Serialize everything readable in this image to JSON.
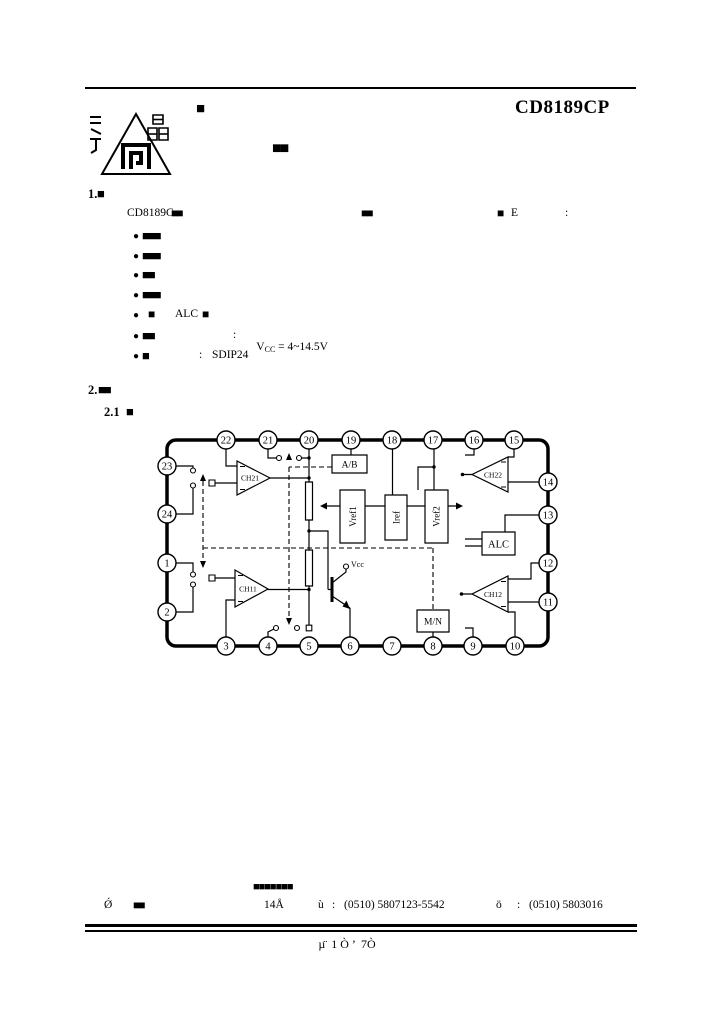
{
  "page": {
    "title": "CD8189CP",
    "top_blob": "■",
    "subtitle_blob": "■■",
    "page_number": "µ̈  1 Ò ’  7Ò"
  },
  "section1": {
    "num": "1.",
    "num_blob": "■",
    "intro": {
      "lead": "CD8189C",
      "blob1": "■■",
      "blob2": "■■",
      "blob3": "■",
      "suffix": "E",
      "colon": ":"
    },
    "bullets": {
      "b1": {
        "dot": "●",
        "blob": "■■■"
      },
      "b2": {
        "dot": "●",
        "blob": "■■■"
      },
      "b3": {
        "dot": "●",
        "blob": "■■"
      },
      "b4": {
        "dot": "●",
        "blob": "■■■"
      },
      "b5": {
        "dot": "●",
        "blob1": "■",
        "text": "ALC",
        "blob2": "■"
      },
      "b6": {
        "dot": "●",
        "blob": "■■",
        "colon": ":",
        "v": "V",
        "vsub": "CC",
        "rest": " = 4~14.5V"
      },
      "b7": {
        "dot": "●",
        "blob": "■",
        "colon": ":",
        "text": "SDIP24"
      }
    }
  },
  "section2": {
    "num": "2.",
    "blob": "■■",
    "subnum": "2.1",
    "subblob": "■"
  },
  "diagram": {
    "pins": {
      "p1": "1",
      "p2": "2",
      "p3": "3",
      "p4": "4",
      "p5": "5",
      "p6": "6",
      "p7": "7",
      "p8": "8",
      "p9": "9",
      "p10": "10",
      "p11": "11",
      "p12": "12",
      "p13": "13",
      "p14": "14",
      "p15": "15",
      "p16": "16",
      "p17": "17",
      "p18": "18",
      "p19": "19",
      "p20": "20",
      "p21": "21",
      "p22": "22",
      "p23": "23",
      "p24": "24"
    },
    "blocks": {
      "amp_ch21": "CH21",
      "amp_ch22": "CH22",
      "amp_ch11": "CH11",
      "amp_ch12": "CH12",
      "ab": "A/B",
      "vref1": "Vref1",
      "iref": "Iref",
      "vref2": "Vref2",
      "alc": "ALC",
      "mn": "M/N",
      "vcc": "Vcc"
    }
  },
  "footer": {
    "address_blob": "■■■■■■■",
    "mark1": "Ǿ",
    "blob1": "■■",
    "code": "14Å",
    "tel_label": "ù",
    "tel_colon": ":",
    "tel": "(0510) 5807123-5542",
    "fax_label": "ö",
    "fax_colon": ":",
    "fax": "(0510) 5803016"
  }
}
